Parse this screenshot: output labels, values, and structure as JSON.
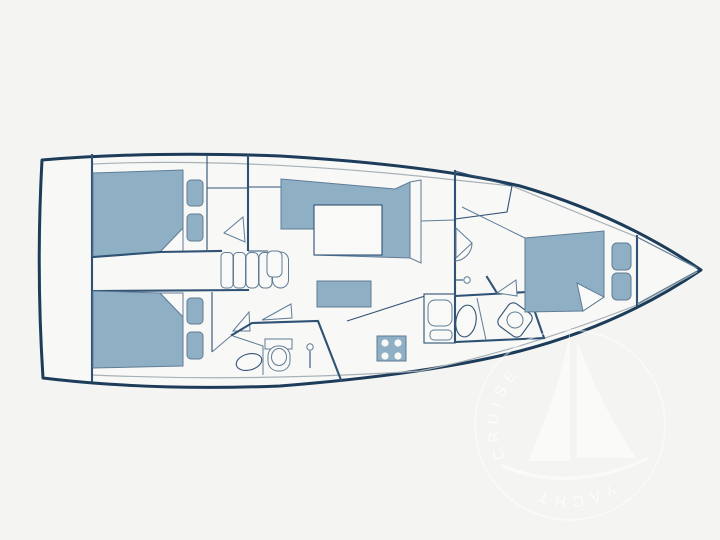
{
  "plan": {
    "type": "sailing-yacht-interior-deck-plan",
    "rooms": [
      "aft-cabin-port",
      "aft-cabin-starboard",
      "companionway-steps",
      "salon",
      "galley",
      "aft-head",
      "forward-head",
      "forward-cabin",
      "bow-locker"
    ],
    "fixtures": [
      "double-bed",
      "pillow",
      "wardrobe-door-swing",
      "settee",
      "salon-table",
      "coffee-table",
      "stove-4-burners",
      "galley-sink",
      "washbasin",
      "toilet",
      "shower-mixer",
      "companionway-steps"
    ]
  },
  "watermark": {
    "text_top": "CRUISE",
    "text_bottom": "YACHT"
  },
  "colors": {
    "background": "#f4f4f2",
    "hull_fill": "#f8f8f6",
    "hull_outline": "#1c3c59",
    "wall_line": "#2f5275",
    "thin_line": "#5f7d97",
    "deck_line": "#a8b1b7",
    "furniture_fill": "#8fafc4",
    "fixture_fill": "#f9f9f7",
    "watermark_white": "#ffffff"
  }
}
